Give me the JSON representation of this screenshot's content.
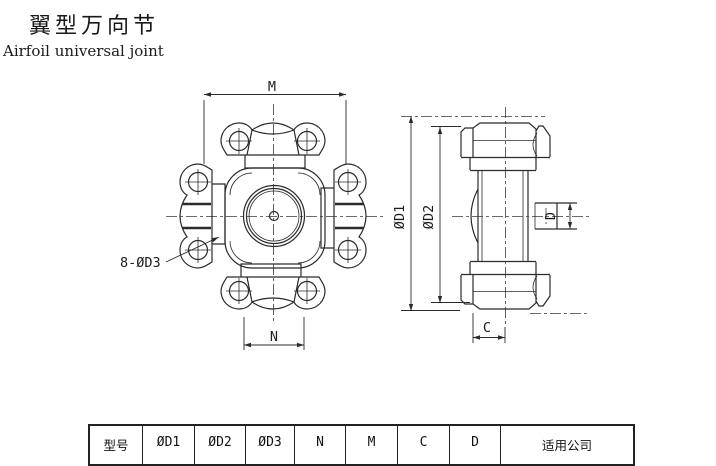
{
  "page": {
    "background": "#ffffff",
    "line_color": "#2b2b2b"
  },
  "title": {
    "zh": "翼型万向节",
    "en": "Airfoil universal joint"
  },
  "drawing": {
    "front_view": {
      "dims": {
        "m": "M",
        "n": "N",
        "bolt_callout": "8-ØD3"
      }
    },
    "side_view": {
      "dims": {
        "d1": "ØD1",
        "d2": "ØD2",
        "c": "C",
        "d": "D"
      }
    }
  },
  "table": {
    "headers": [
      "型号",
      "ØD1",
      "ØD2",
      "ØD3",
      "N",
      "M",
      "C",
      "D",
      "适用公司"
    ]
  }
}
